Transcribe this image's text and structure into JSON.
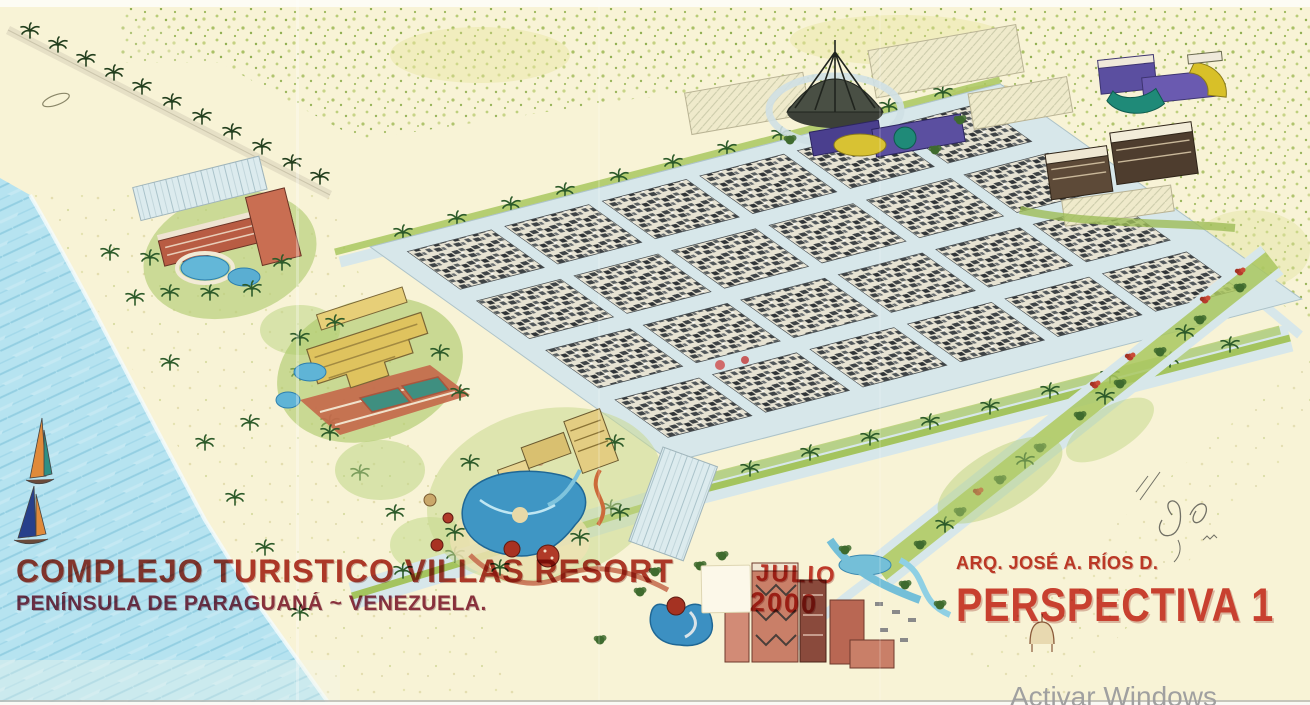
{
  "artwork": {
    "title": "COMPLEJO TURISTICO VILLAS RESORT",
    "subtitle": "PENÍNSULA DE PARAGUANÁ ~ VENEZUELA.",
    "date_month": "JULIO",
    "date_year": "2000",
    "credit": "ARQ. JOSÉ A. RÍOS D.",
    "sheet_label": "PERSPECTIVA 1"
  },
  "watermark": {
    "text": "Activar Windows"
  },
  "scene": {
    "elements": [
      "ocean",
      "sailboats",
      "beach",
      "palm-rows",
      "villas-grid",
      "hotels-with-pools",
      "waterpark",
      "convention-dome",
      "parking-lots",
      "boulevards",
      "scrubland",
      "architect-signature"
    ]
  },
  "colors": {
    "paper": "#f8f3d6",
    "ocean": "#b6e3f0",
    "road": "#d7e7ea",
    "vegetation": "#a9c75f",
    "title_red": "#b13a2e",
    "subtitle_maroon": "#8d3347",
    "stamp_red": "#c43b30",
    "watermark_gray": "#a0a0a0"
  }
}
